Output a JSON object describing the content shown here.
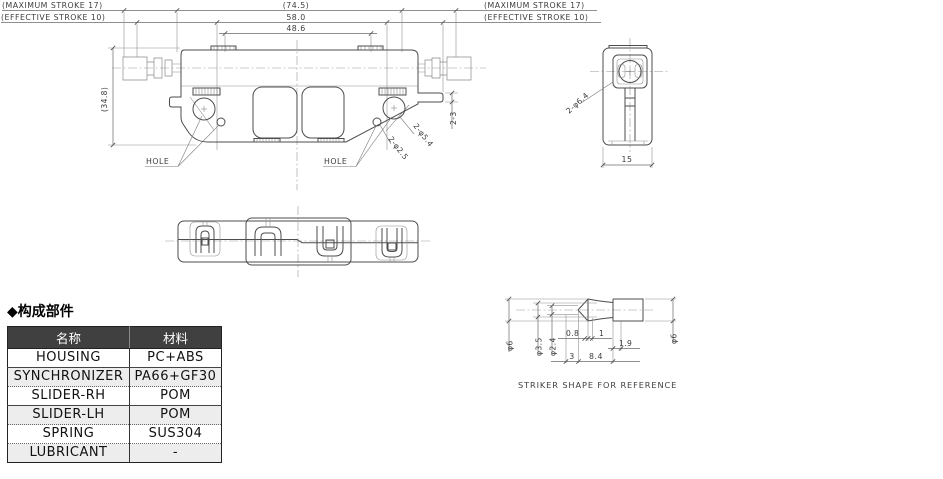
{
  "drawing": {
    "front": {
      "stroke_max_left": "(MAXIMUM STROKE 17)",
      "stroke_eff_left": "(EFFECTIVE STROKE 10)",
      "stroke_max_right": "(MAXIMUM STROKE 17)",
      "stroke_eff_right": "(EFFECTIVE STROKE 10)",
      "dim_overall": "(74.5)",
      "dim_body": "58.0",
      "dim_inner": "48.6",
      "dim_height": "(34.8)",
      "dim_tab": "2-3",
      "dim_hole_large": "2-φ5.4",
      "dim_hole_small": "2-φ2.5",
      "hole_label_left": "HOLE",
      "hole_label_right": "HOLE"
    },
    "side": {
      "dim_opening": "2-φ6.4",
      "dim_width": "15"
    },
    "striker": {
      "dim_d6_left": "φ6",
      "dim_d35": "φ3.5",
      "dim_d24": "φ2.4",
      "dim_08": "0.8",
      "dim_1": "1",
      "dim_19": "1.9",
      "dim_3": "3",
      "dim_84": "8.4",
      "dim_d6_right": "φ6",
      "caption": "STRIKER SHAPE FOR REFERENCE"
    }
  },
  "components": {
    "heading": "◆构成部件",
    "col_name": "名称",
    "col_material": "材料",
    "rows": [
      {
        "name": "HOUSING",
        "material": "PC+ABS"
      },
      {
        "name": "SYNCHRONIZER",
        "material": "PA66+GF30"
      },
      {
        "name": "SLIDER-RH",
        "material": "POM"
      },
      {
        "name": "SLIDER-LH",
        "material": "POM"
      },
      {
        "name": "SPRING",
        "material": "SUS304"
      },
      {
        "name": "LUBRICANT",
        "material": "-"
      }
    ]
  },
  "colors": {
    "line": "#4d4d4d",
    "table_header_bg": "#404040",
    "table_header_text": "#ffffff",
    "row_alt_bg": "#ededed"
  }
}
